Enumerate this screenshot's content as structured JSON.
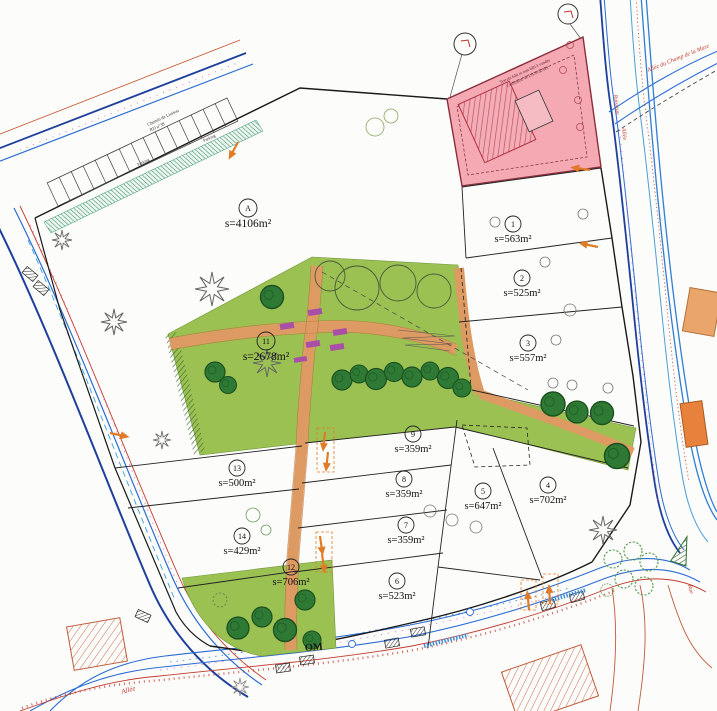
{
  "plan": {
    "type": "subdivision-site-plan",
    "colors": {
      "park_green": "#9cc153",
      "tree_green": "#2e7a35",
      "path_orange": "#dd9a62",
      "planter_purple": "#a94fa8",
      "pink_parcel": "#f4a9b3",
      "road_blue": "#2b6cd4",
      "road_dark_blue": "#1e3f9c",
      "curb_red": "#c23b2f",
      "access_orange": "#e07b28",
      "annotation_magenta": "#e26ab0"
    }
  },
  "parcels": [
    {
      "id": "A",
      "area": "s=4106m²"
    },
    {
      "id": "1",
      "area": "s=563m²"
    },
    {
      "id": "2",
      "area": "s=525m²"
    },
    {
      "id": "3",
      "area": "s=557m²"
    },
    {
      "id": "4",
      "area": "s=702m²"
    },
    {
      "id": "5",
      "area": "s=647m²"
    },
    {
      "id": "6",
      "area": "s=523m²"
    },
    {
      "id": "7",
      "area": "s=359m²"
    },
    {
      "id": "8",
      "area": "s=359m²"
    },
    {
      "id": "9",
      "area": "s=359m²"
    },
    {
      "id": "11",
      "area": "s=2678m²"
    },
    {
      "id": "12",
      "area": "s=706m²"
    },
    {
      "id": "13",
      "area": "s=500m²"
    },
    {
      "id": "14",
      "area": "s=429m²"
    }
  ],
  "labels": {
    "allee_mare": "Allée du Champ de la Mare",
    "ruisseau": "Ruisseau",
    "allee_right": "Allée",
    "om": "OM",
    "allee_bottom": "Allée",
    "rue_bottom": "Rue",
    "chemin_line1": "Chemin de Liaison",
    "chemin_line2": "RD n°38",
    "parking_a": "Parking",
    "parking_b": "Parking"
  },
  "pink_parcel": {
    "line1": "Terrain bâti et non bâti à vendre",
    "line2": "Commune de LANGEAIS"
  }
}
